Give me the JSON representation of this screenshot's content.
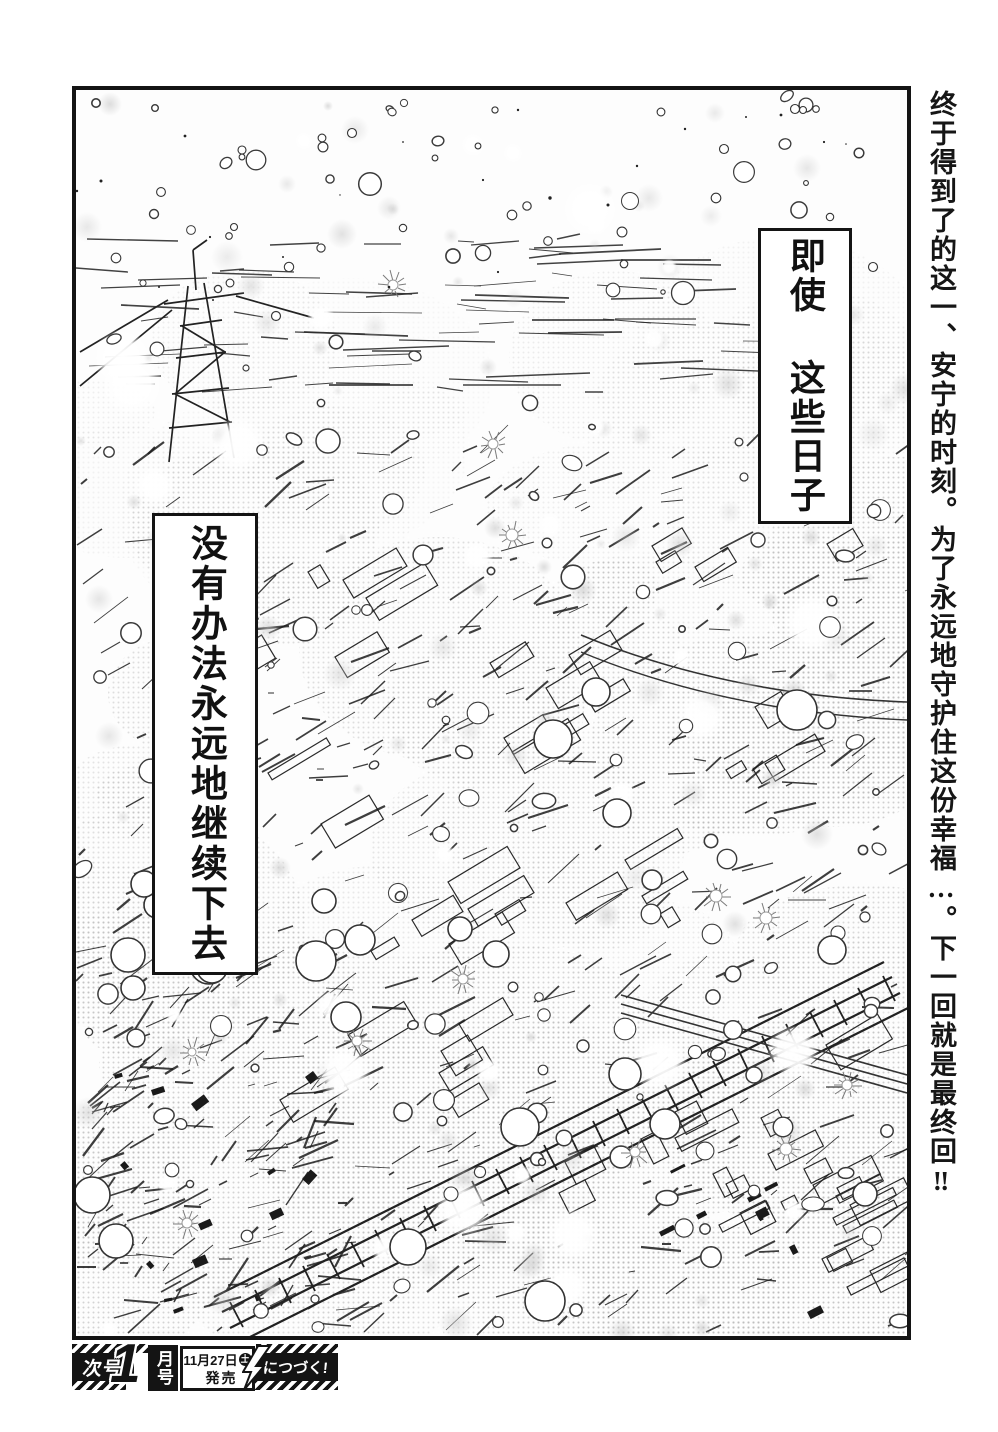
{
  "page_type": "manga-page",
  "margin_note": {
    "text": "终于得到了的这一、安宁的时刻。为了永远地守护住这份幸福…。下一回就是最终回‼"
  },
  "captions": {
    "right_box": "即使 这些日子",
    "left_box": "没有办法永远地继续下去"
  },
  "footer": {
    "next_issue": "次号",
    "issue_number": "1",
    "issue_month_suffix": "月号",
    "release_date": "11月27日",
    "release_weekday": "土",
    "release_action": "発売",
    "continuation": "につづく!"
  },
  "colors": {
    "ink": "#141414",
    "paper": "#ffffff"
  }
}
